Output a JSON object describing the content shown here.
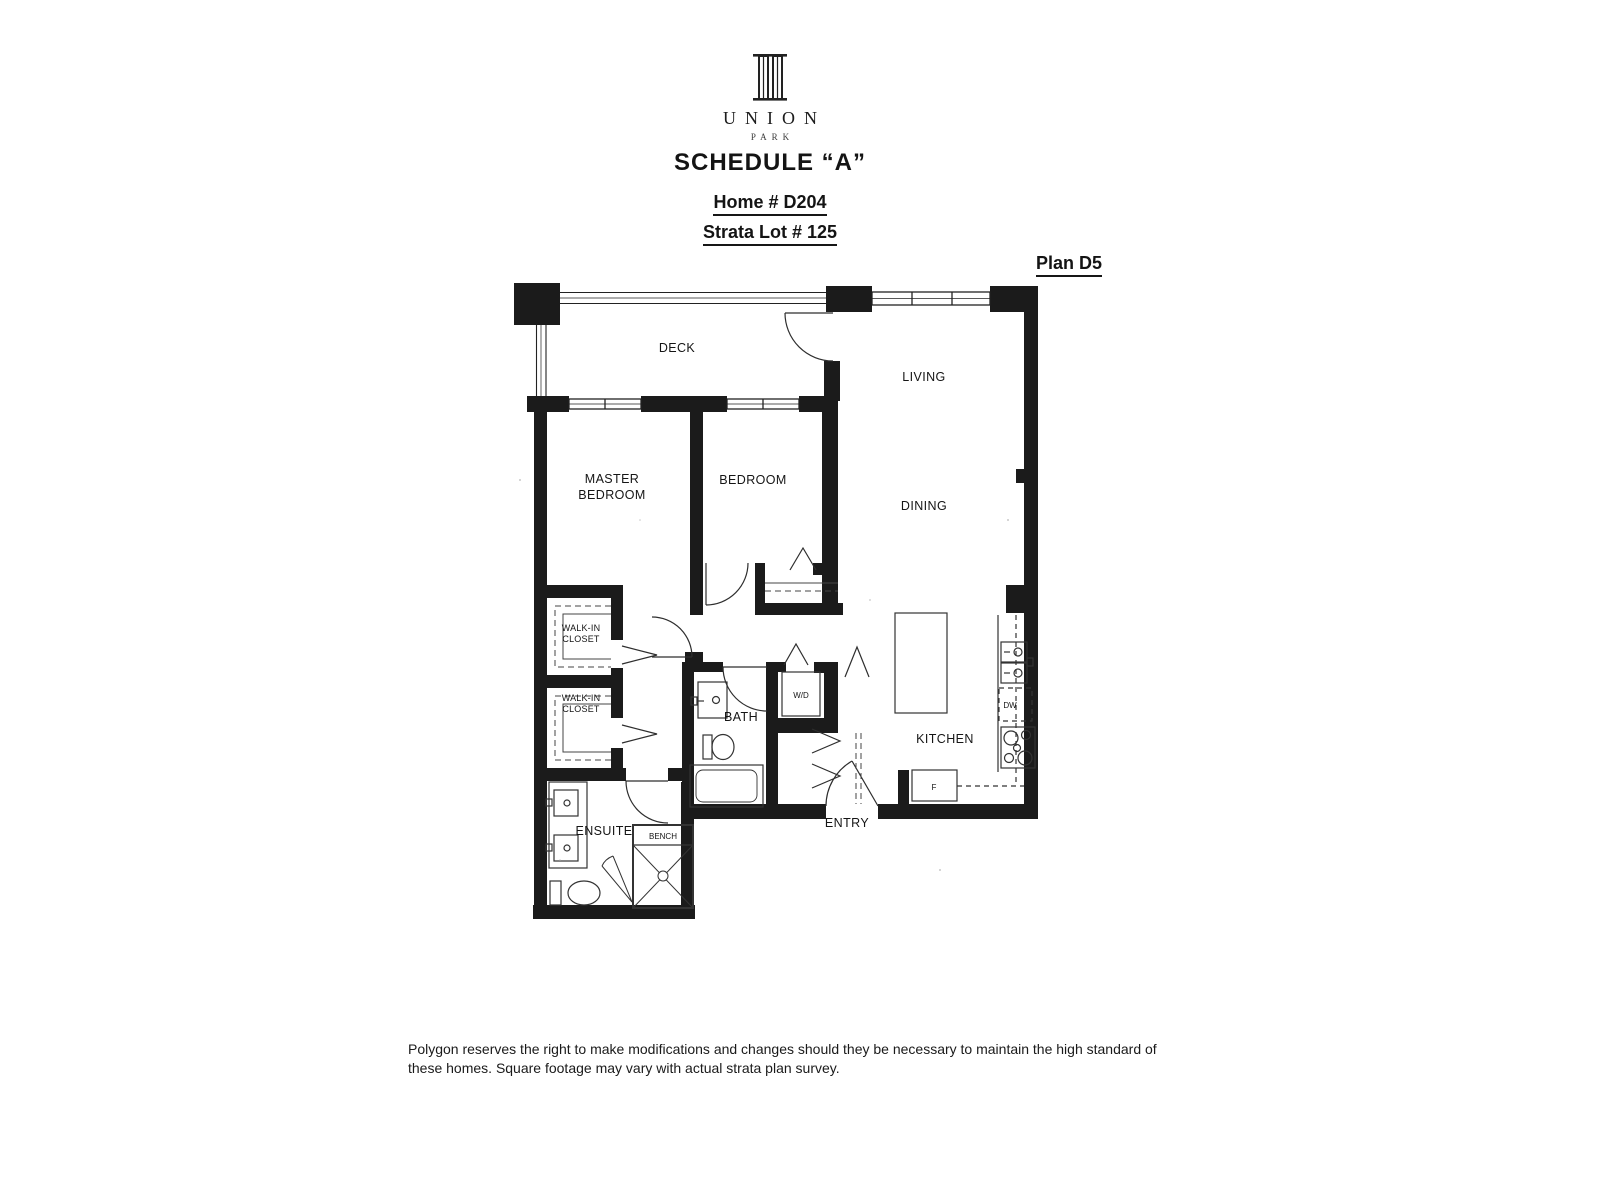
{
  "document": {
    "brand": {
      "name": "UNION",
      "subtitle": "PARK"
    },
    "schedule_title": "SCHEDULE “A”",
    "home_number": "Home # D204",
    "strata_lot": "Strata Lot # 125",
    "plan_number": "Plan D5",
    "disclaimer_line1": "Polygon reserves the right to make modifications and changes should they be necessary to maintain the high standard of",
    "disclaimer_line2": "these homes. Square footage may vary with actual strata plan survey."
  },
  "floor_plan": {
    "rooms": {
      "deck": "DECK",
      "living": "LIVING",
      "dining": "DINING",
      "master_bedroom_line1": "MASTER",
      "master_bedroom_line2": "BEDROOM",
      "bedroom": "BEDROOM",
      "walk_in_closet_line1": "WALK-IN",
      "walk_in_closet_line2": "CLOSET",
      "bath": "BATH",
      "ensuite": "ENSUITE",
      "kitchen": "KITCHEN",
      "entry": "ENTRY"
    },
    "fixtures": {
      "washer_dryer": "W/D",
      "fridge": "F",
      "dishwasher": "DW",
      "bench": "BENCH"
    }
  },
  "colors": {
    "ink": "#1c1c1c",
    "paper": "#ffffff"
  }
}
